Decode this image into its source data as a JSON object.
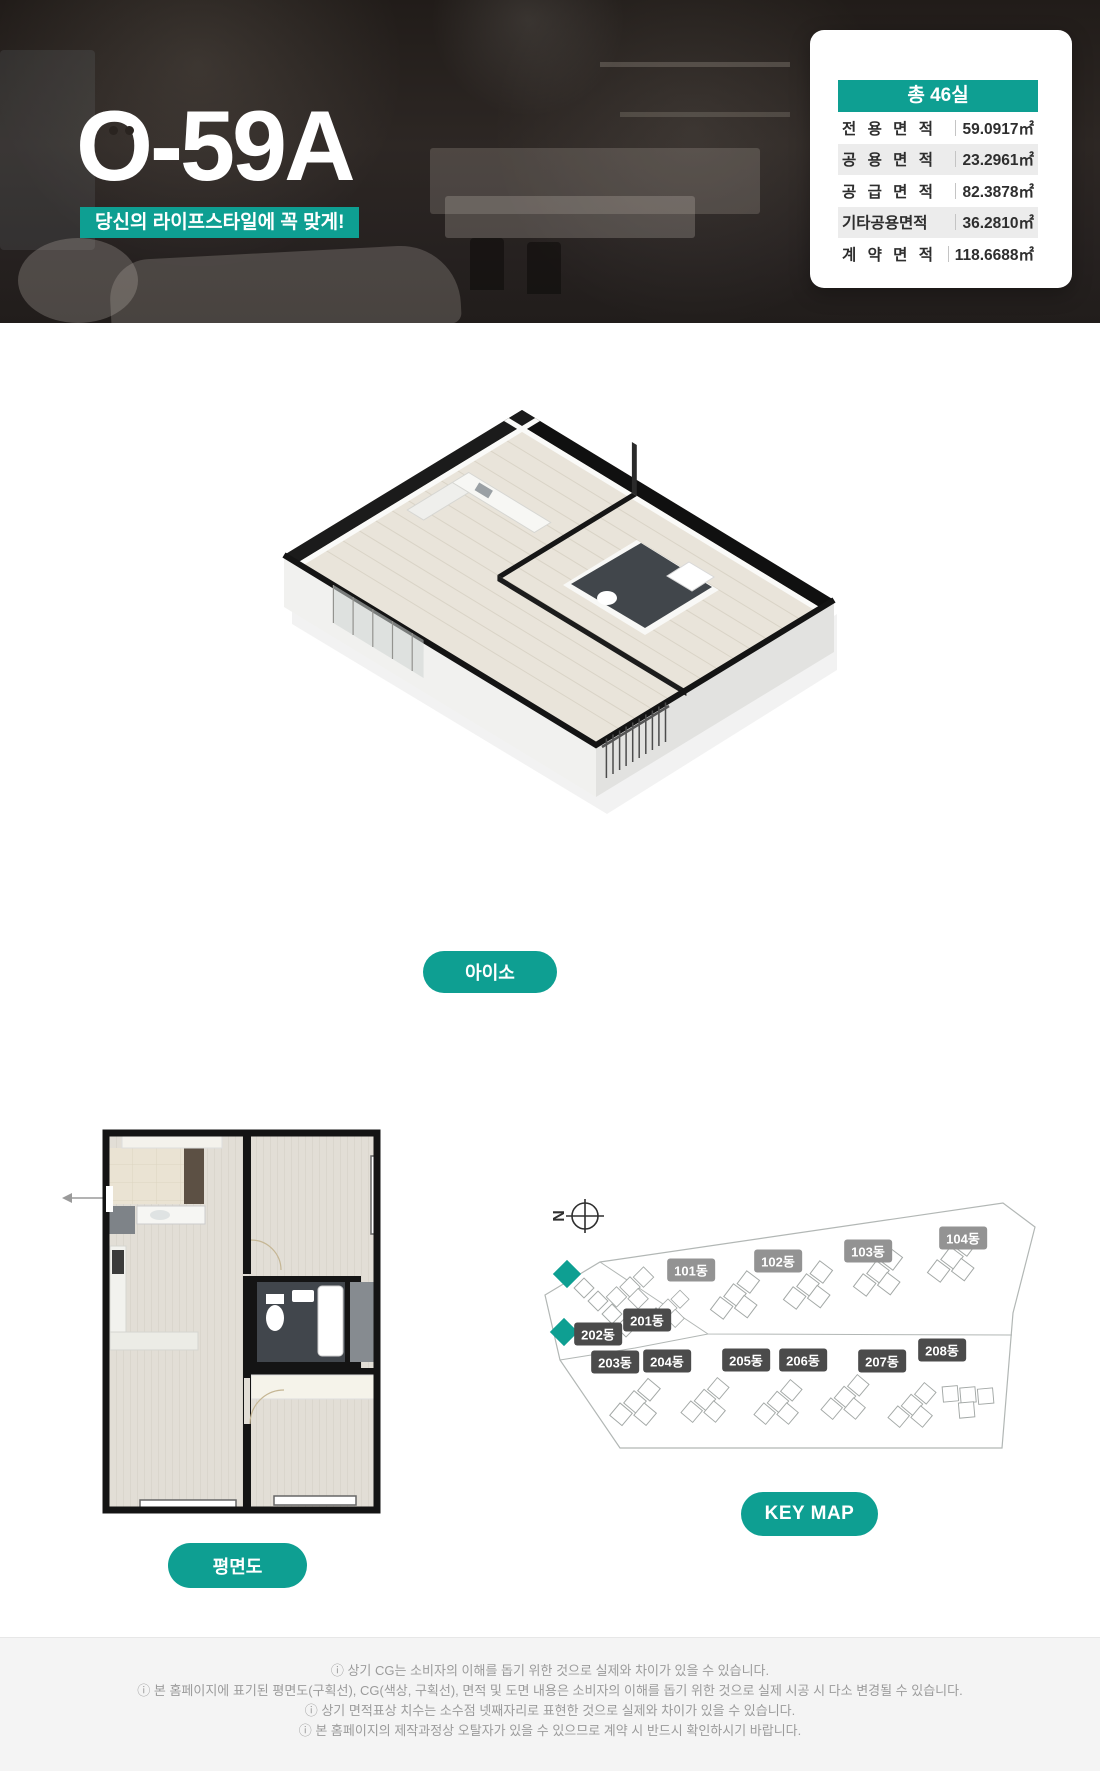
{
  "hero": {
    "title": "O-59A",
    "tagline": "당신의 라이프스타일에 꼭 맞게!",
    "card": {
      "header": "총 46실",
      "rows": [
        {
          "label": "전 용 면 적",
          "value": "59.0917㎡"
        },
        {
          "label": "공 용 면 적",
          "value": "23.2961㎡"
        },
        {
          "label": "공 급 면 적",
          "value": "82.3878㎡"
        },
        {
          "label": "기타공용면적",
          "value": "36.2810㎡"
        },
        {
          "label": "계 약 면 적",
          "value": "118.6688㎡"
        }
      ]
    }
  },
  "iso": {
    "button": "아이소"
  },
  "plan2d": {
    "button": "평면도"
  },
  "keymap": {
    "button": "KEY MAP",
    "compass_letter": "N",
    "labels": [
      {
        "text": "101동",
        "x": 151,
        "y": 80,
        "tone": "light"
      },
      {
        "text": "102동",
        "x": 238,
        "y": 71,
        "tone": "light"
      },
      {
        "text": "103동",
        "x": 328,
        "y": 61,
        "tone": "light"
      },
      {
        "text": "104동",
        "x": 423,
        "y": 48,
        "tone": "light"
      },
      {
        "text": "201동",
        "x": 107,
        "y": 130,
        "tone": "dark"
      },
      {
        "text": "202동",
        "x": 58,
        "y": 144,
        "tone": "dark"
      },
      {
        "text": "203동",
        "x": 75,
        "y": 172,
        "tone": "dark"
      },
      {
        "text": "204동",
        "x": 127,
        "y": 171,
        "tone": "dark"
      },
      {
        "text": "205동",
        "x": 206,
        "y": 170,
        "tone": "dark"
      },
      {
        "text": "206동",
        "x": 263,
        "y": 170,
        "tone": "dark"
      },
      {
        "text": "207동",
        "x": 342,
        "y": 171,
        "tone": "dark"
      },
      {
        "text": "208동",
        "x": 402,
        "y": 160,
        "tone": "dark"
      }
    ]
  },
  "footer": {
    "lines": [
      "ⓘ 상기 CG는 소비자의 이해를 돕기 위한 것으로 실제와 차이가 있을 수 있습니다.",
      "ⓘ 본 홈페이지에 표기된 평면도(구획선), CG(색상, 구획선), 면적 및 도면 내용은 소비자의 이해를 돕기 위한 것으로 실제 시공 시 다소 변경될 수 있습니다.",
      "ⓘ 상기 면적표상 치수는 소수점 넷째자리로 표현한 것으로 실제와 차이가 있을 수 있습니다.",
      "ⓘ 본 홈페이지의 제작과정상 오탈자가 있을 수 있으므로 계약 시 반드시 확인하시기 바랍니다."
    ]
  },
  "colors": {
    "accent": "#0E9F92",
    "chip_dark": "#4b4b4b",
    "chip_light": "#939393",
    "footer_text": "#9b9b9b",
    "wall_black": "#141414"
  }
}
